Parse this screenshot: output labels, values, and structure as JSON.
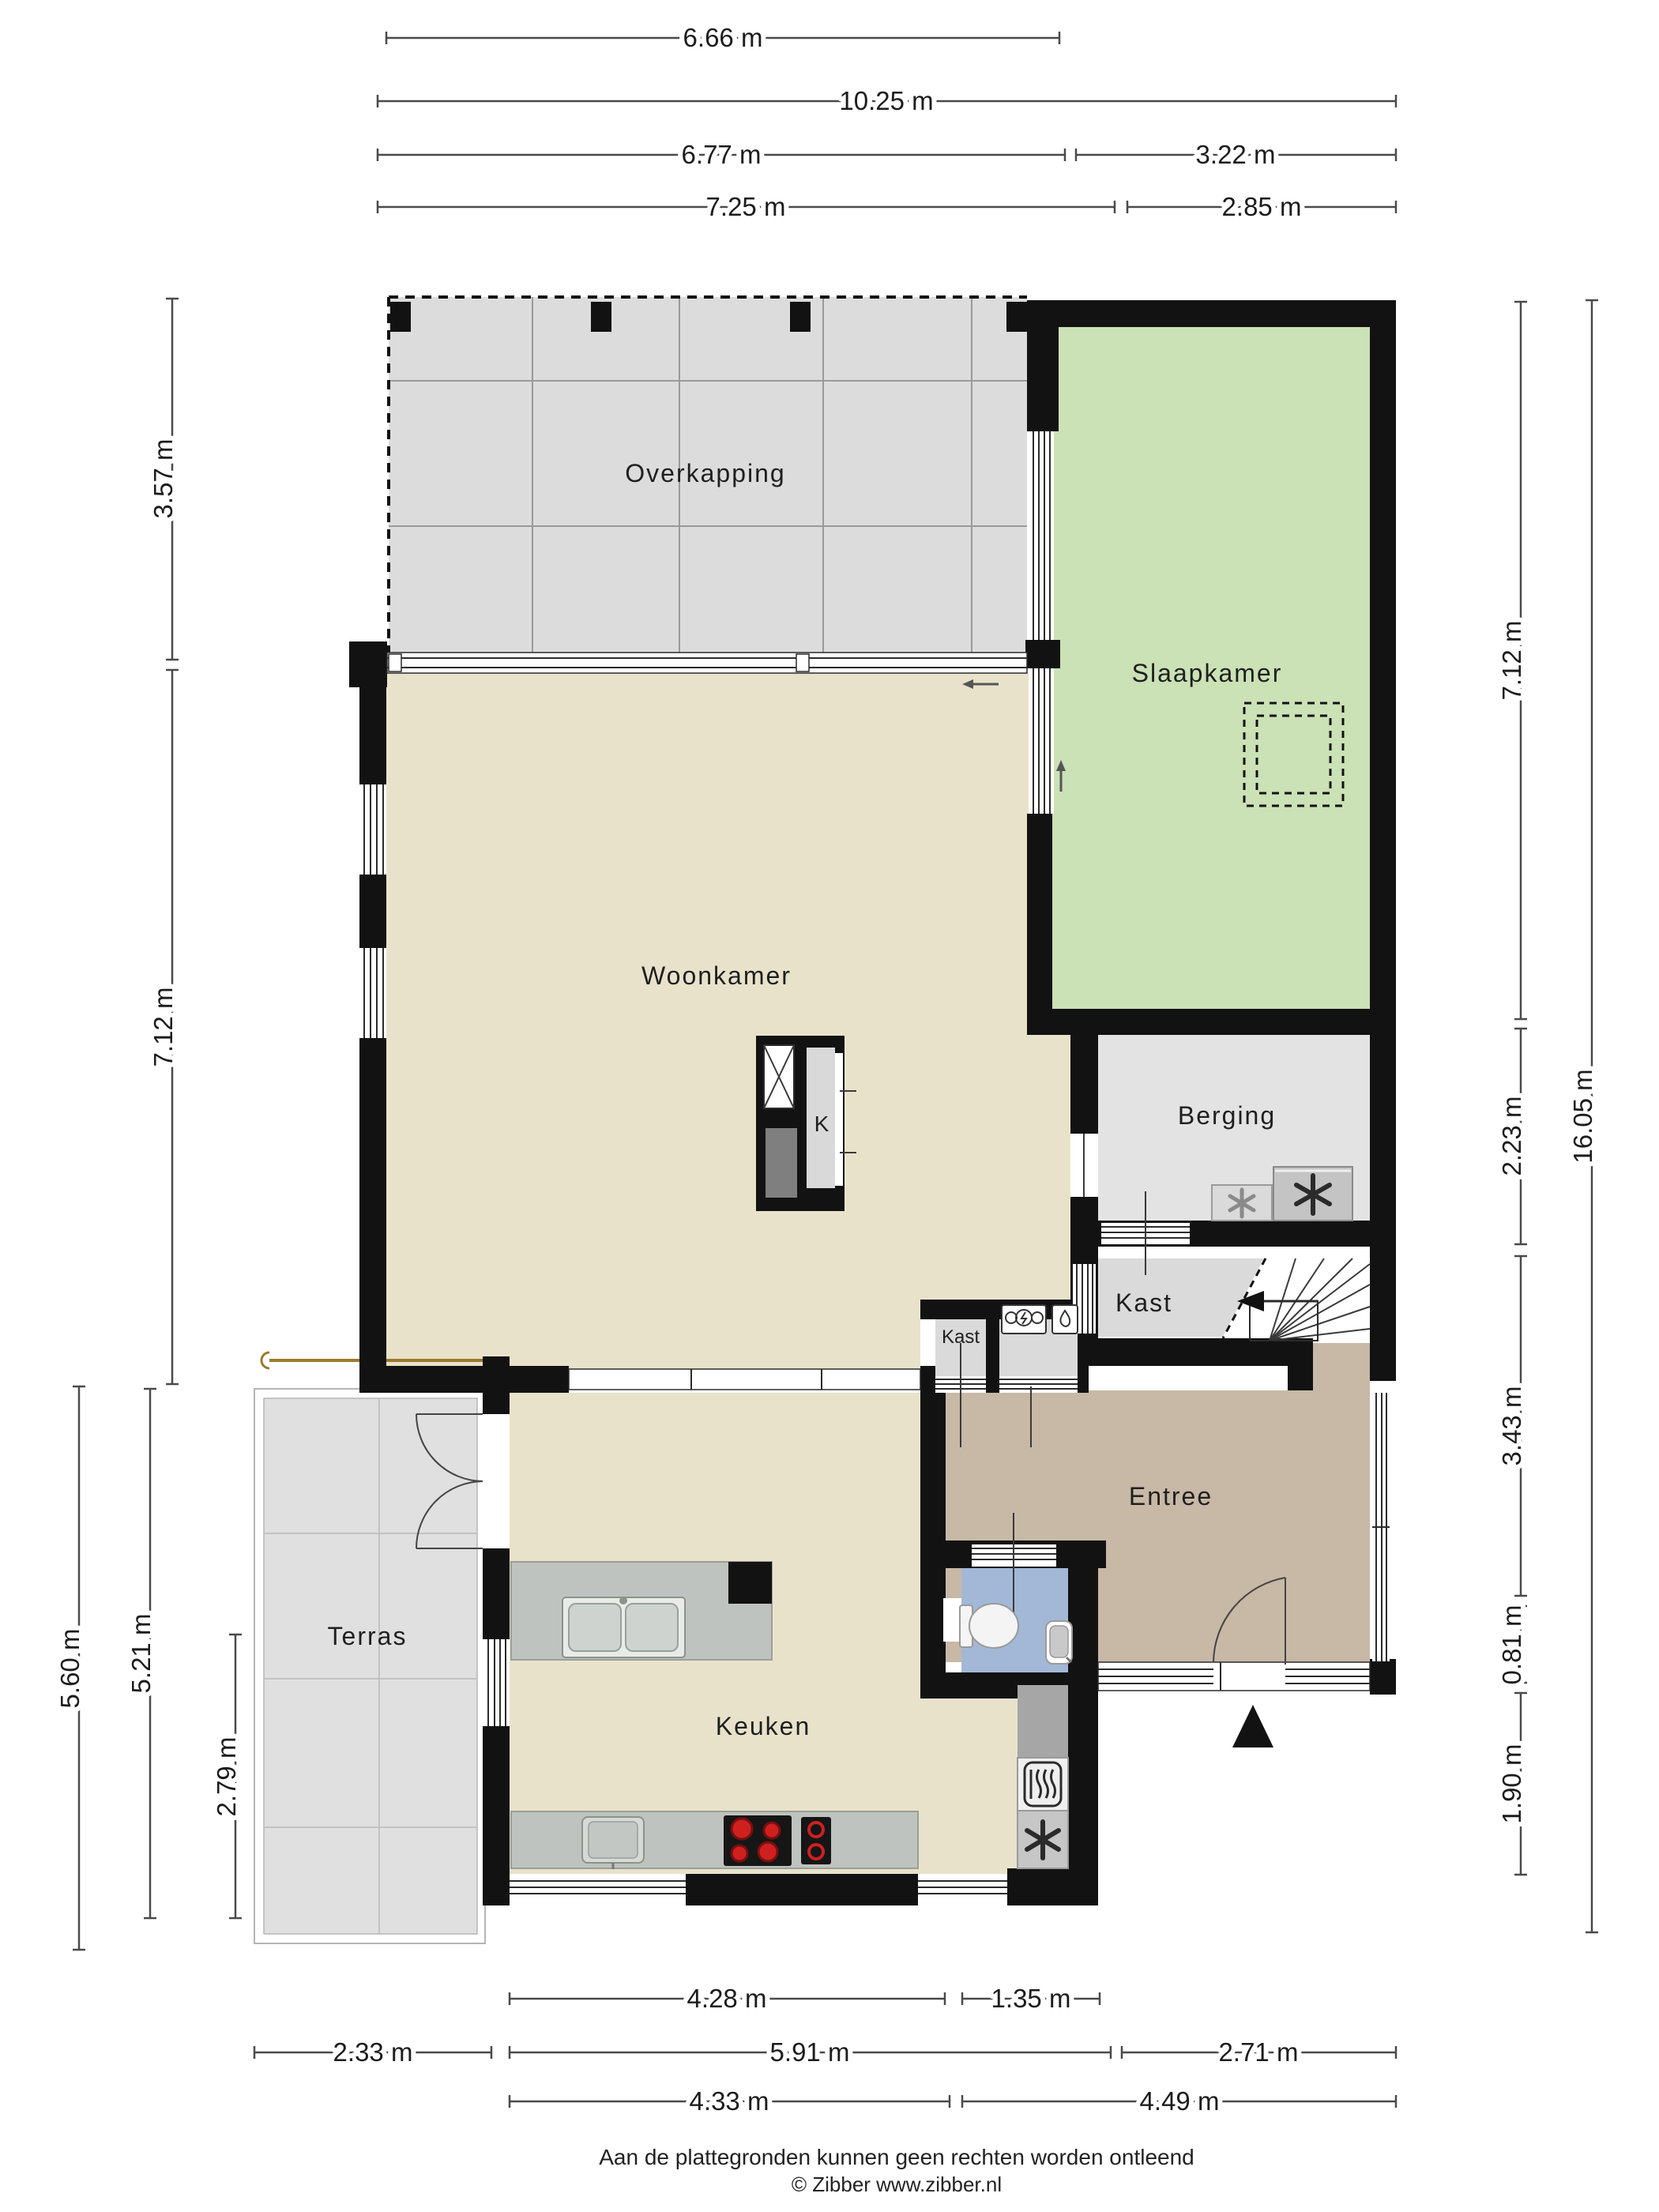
{
  "rooms": {
    "overkapping": "Overkapping",
    "slaapkamer": "Slaapkamer",
    "woonkamer": "Woonkamer",
    "k": "K",
    "berging": "Berging",
    "kast_groot": "Kast",
    "kast_klein": "Kast",
    "entree": "Entree",
    "terras": "Terras",
    "keuken": "Keuken"
  },
  "dims": {
    "top": [
      "6.66 m",
      "10.25 m",
      "6.77 m",
      "3.22 m",
      "7.25 m",
      "2.85 m"
    ],
    "left": [
      "3.57 m",
      "7.12 m",
      "5.60 m",
      "5.21 m",
      "2.79 m"
    ],
    "right": [
      "7.12 m",
      "16.05 m",
      "2.23 m",
      "3.43 m",
      "0.81 m",
      "1.90 m"
    ],
    "bottom": [
      "4.28 m",
      "1.35 m",
      "2.33 m",
      "5.91 m",
      "2.71 m",
      "4.33 m",
      "4.49 m"
    ]
  },
  "footer": {
    "disclaimer": "Aan de plattegronden kunnen geen rechten worden ontleend",
    "credit": "© Zibber www.zibber.nl"
  },
  "colors": {
    "wall": "#121212",
    "floor_living": "#e9e2cb",
    "floor_bedroom": "#cbe1b6",
    "floor_storage": "#e3e3e3",
    "floor_entry": "#c8b8a6",
    "floor_toilet": "#a3b8d6",
    "floor_patio": "#dcdcdc",
    "counter": "#bfc3bf",
    "burner_red": "#cf2020"
  }
}
